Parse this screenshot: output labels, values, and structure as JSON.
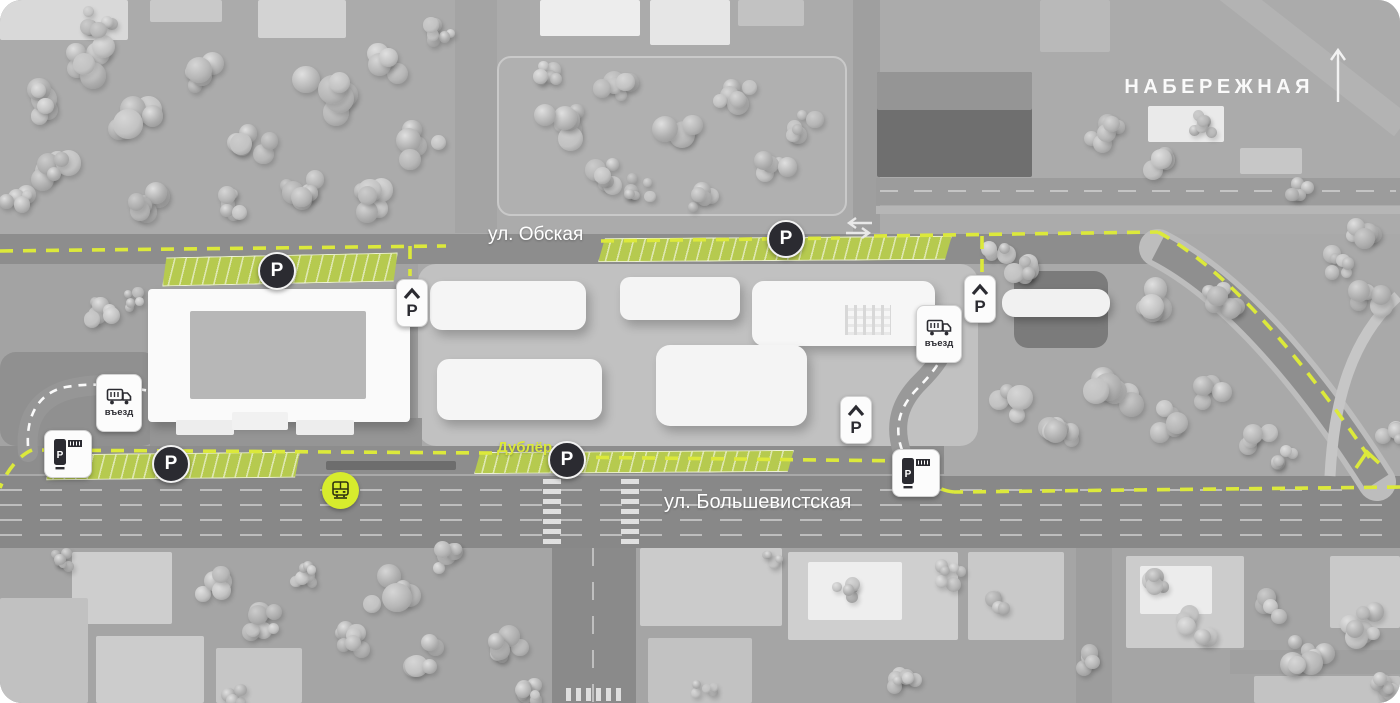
{
  "labels": {
    "embankment": "НАБЕРЕЖНАЯ",
    "street_obskaya": "ул. Обская",
    "street_dubler": "Дублёр",
    "street_bolshevistskaya": "ул. Большевистская"
  },
  "signs": {
    "parking_letter": "P",
    "truck_entrance_label": "въезд"
  },
  "icons": {
    "north_arrow": "north-arrow-icon",
    "two_way_traffic": "two-way-arrows-icon",
    "parking_badge": "parking-p-badge",
    "underground_parking": "underground-parking-chevron-p-icon",
    "truck_entrance": "truck-icon",
    "parking_meter": "parking-meter-icon",
    "tram_stop": "tram-icon"
  },
  "colors": {
    "route_dash": "#dce93b",
    "parking_strip_fill": "#b6ca4f",
    "badge_background": "#2b2b31",
    "tram_stop_fill": "#d7ec2d",
    "street_label_text": "#ffffff"
  }
}
